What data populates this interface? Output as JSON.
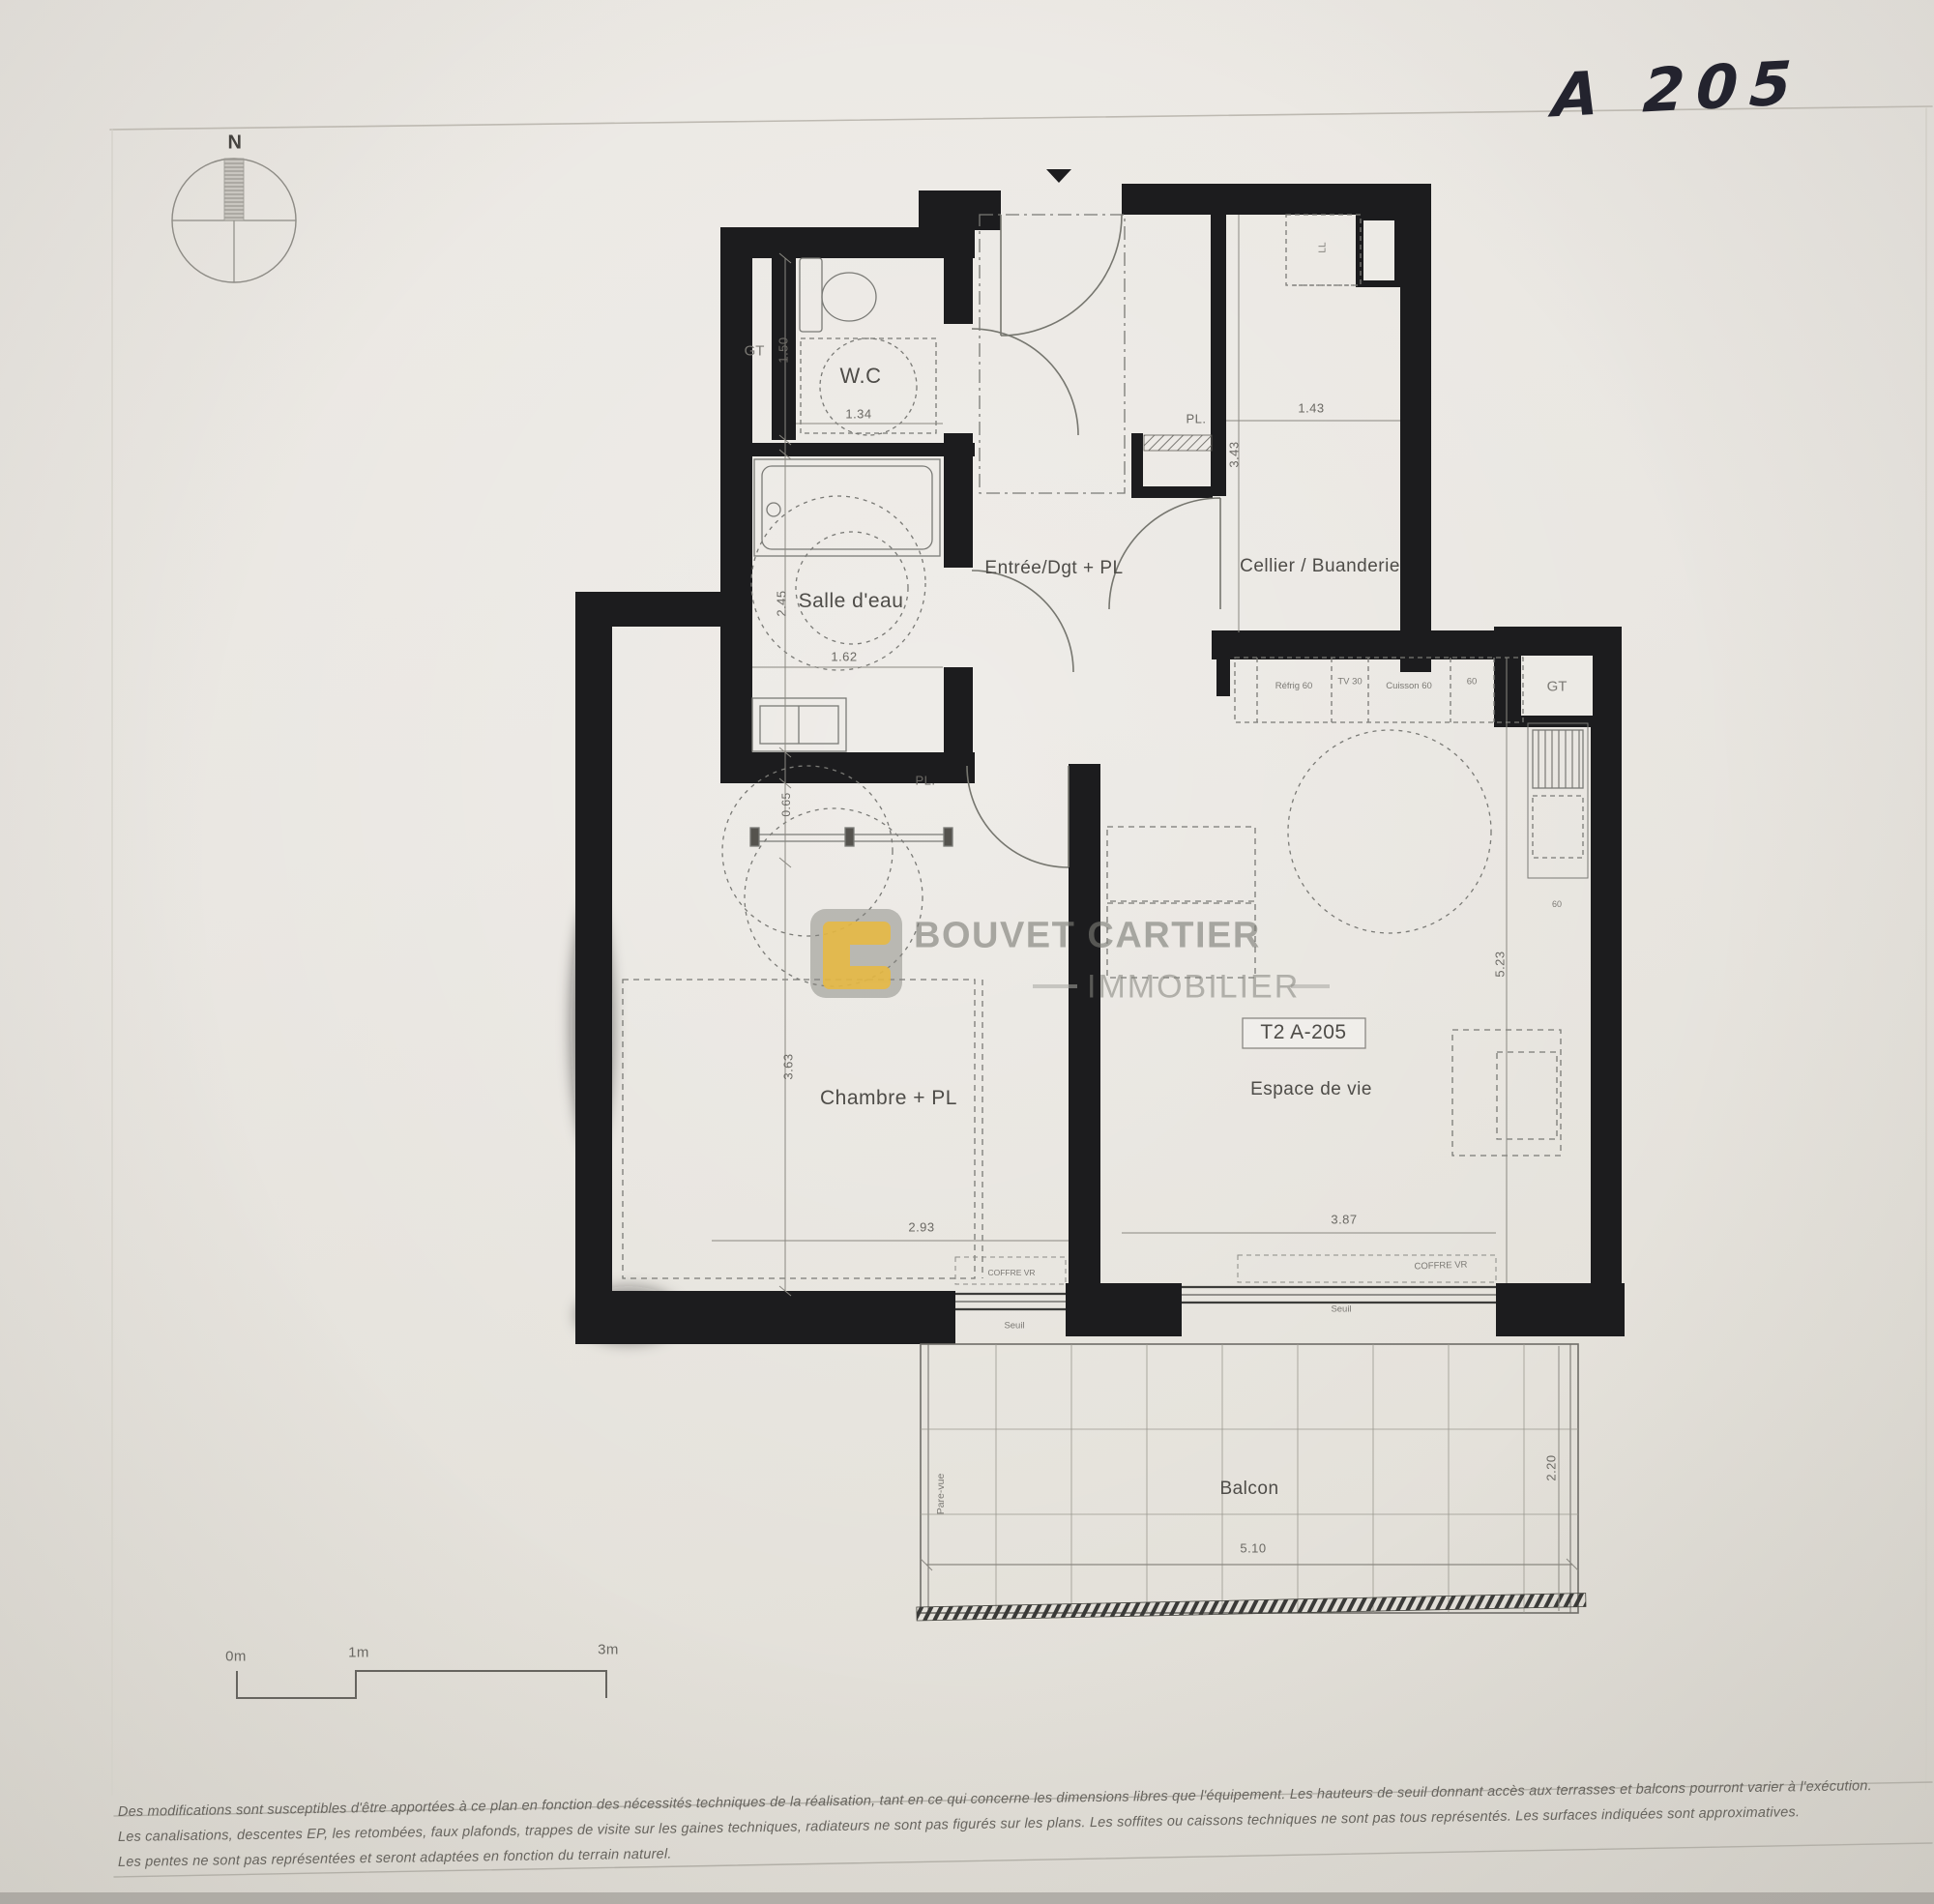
{
  "annotation": {
    "handwritten": "A 205"
  },
  "compass": {
    "north": "N"
  },
  "unit": {
    "label": "T2 A-205"
  },
  "rooms": {
    "gt_top": {
      "name": "GT"
    },
    "wc": {
      "name": "W.C",
      "width": "1.34",
      "height": "1.50"
    },
    "salle_eau": {
      "name": "Salle d'eau",
      "width": "1.62",
      "height": "2.45"
    },
    "entree": {
      "name": "Entrée/Dgt + PL",
      "pl": "PL.",
      "cellier_height": "3.43"
    },
    "cellier": {
      "name": "Cellier / Buanderie",
      "width": "1.43"
    },
    "chambre": {
      "name": "Chambre + PL",
      "pl": "PL.",
      "closet_depth": "0.65",
      "height": "3.63",
      "width": "2.93"
    },
    "espace": {
      "name": "Espace de vie",
      "width": "3.87",
      "height": "5.23"
    },
    "balcon": {
      "name": "Balcon",
      "width": "5.10",
      "height": "2.20",
      "screen": "Pare-vue"
    },
    "gt_kitchen": {
      "name": "GT"
    }
  },
  "kitchen": {
    "washer": "LL",
    "appliances": [
      "Réfrig 60",
      "TV 30",
      "Cuisson 60",
      "60"
    ],
    "sink": "60"
  },
  "windows": {
    "coffre_vr": "COFFRE VR",
    "seuil": "Seuil"
  },
  "scale_bar": {
    "zero": "0m",
    "one": "1m",
    "three": "3m"
  },
  "logo": {
    "line1": "BOUVET CARTIER",
    "line2": "IMMOBILIER"
  },
  "disclaimer": {
    "line1": "Des modifications sont susceptibles d'être apportées à ce plan en fonction des nécessités techniques de la réalisation, tant en ce qui concerne les dimensions libres que l'équipement. Les hauteurs de seuil donnant accès aux terrasses et balcons pourront varier à l'exécution.",
    "line2": "Les canalisations, descentes EP, les retombées, faux plafonds, trappes de visite sur les gaines techniques, radiateurs ne sont pas figurés sur les plans. Les soffites ou caissons techniques ne sont pas tous représentés. Les surfaces indiquées sont approximatives.",
    "line3": "Les pentes ne sont pas représentées et seront adaptées en fonction du terrain naturel."
  }
}
